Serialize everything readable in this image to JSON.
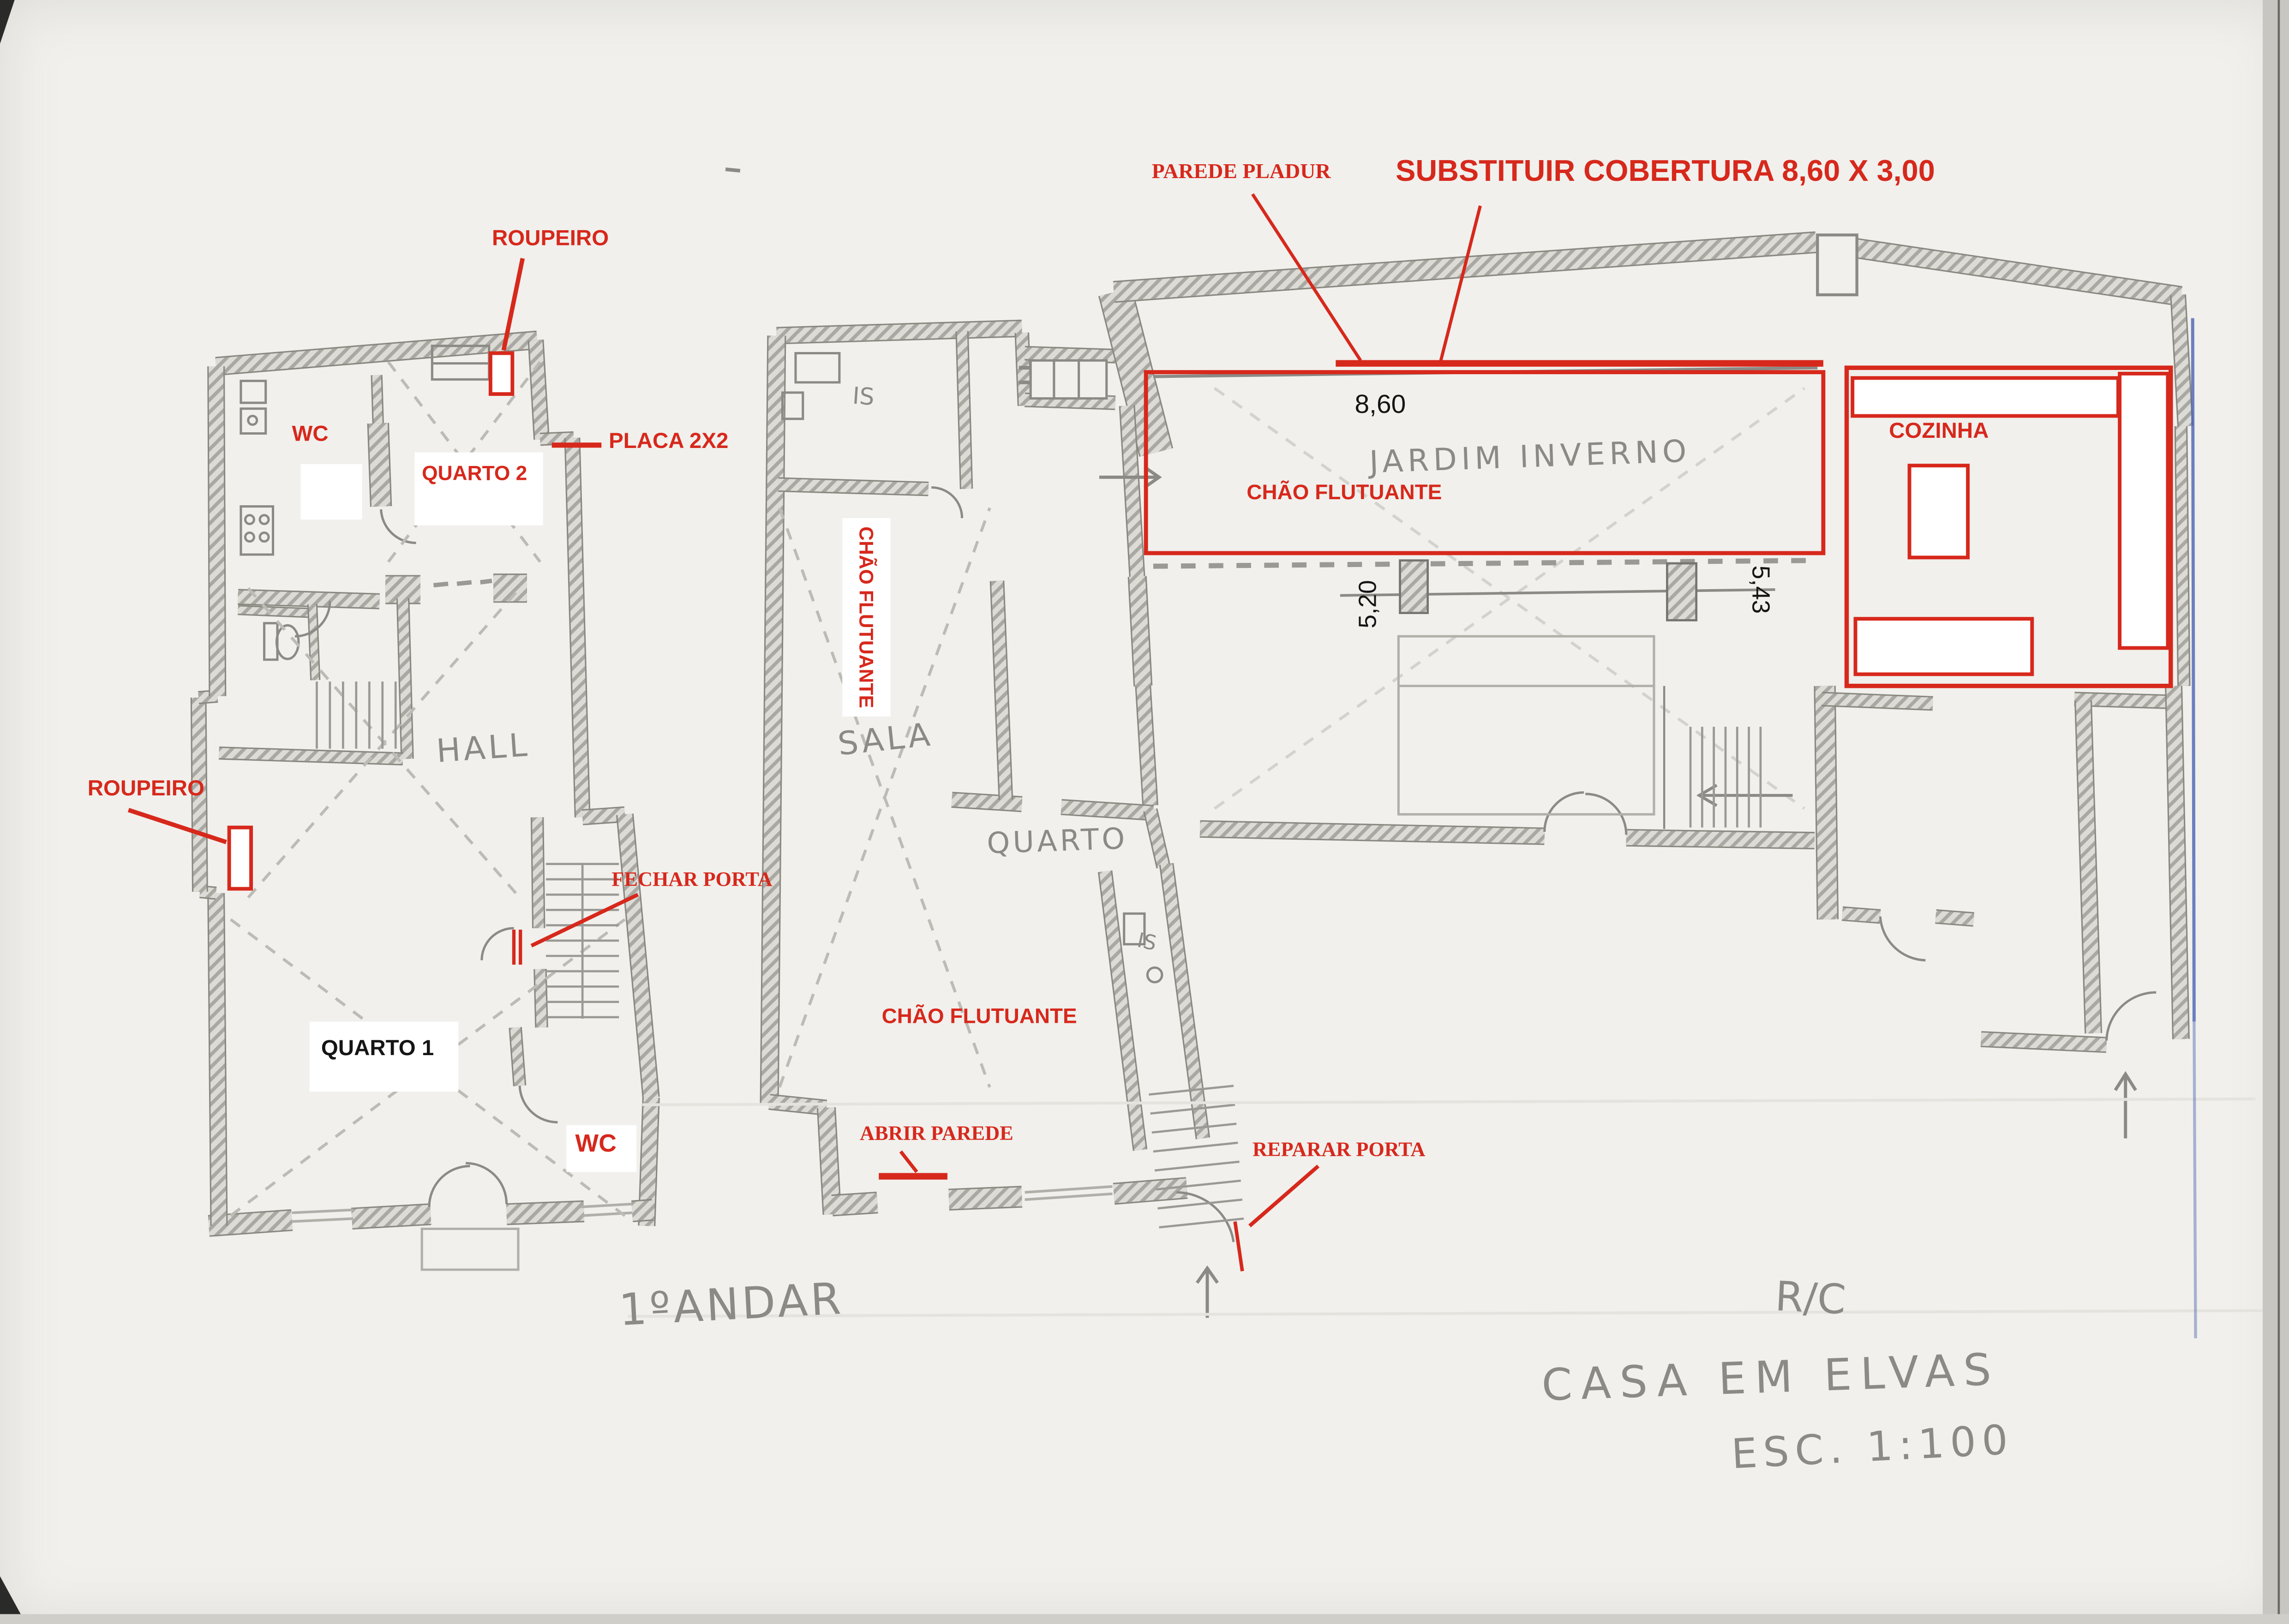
{
  "page": {
    "kind": "scanned hand-drawn architectural floor plan with red renovation notes"
  },
  "colors": {
    "annotation_red": "#d7281c",
    "pencil_gray": "#8b8a85",
    "paper": "#f1f0ec",
    "blue_pen": "#4a63b5",
    "black": "#151515"
  },
  "plans": {
    "left": {
      "name": "1ºANDAR",
      "rooms": {
        "wc_upper": "WC",
        "quarto2": "QUARTO 2",
        "hall": "HALL",
        "quarto1": "QUARTO 1",
        "wc_lower": "WC"
      },
      "red_notes": {
        "roupeiro_top": "ROUPEIRO",
        "roupeiro_left": "ROUPEIRO",
        "placa": "PLACA 2X2",
        "fechar_porta": "FECHAR PORTA"
      }
    },
    "right": {
      "name": "R/C",
      "rooms": {
        "is_top": "IS",
        "sala": "SALA",
        "quarto": "QUARTO",
        "is_mid": "IS",
        "jardim_inverno": "JARDIM INVERNO",
        "cozinha": "COZINHA"
      },
      "red_notes": {
        "parede_pladur": "PAREDE PLADUR",
        "substituir_cobertura": "SUBSTITUIR COBERTURA 8,60 X 3,00",
        "chao_flutuante_upper": "CHÃO FLUTUANTE",
        "chao_flutuante_vertical": "CHÃO FLUTUANTE",
        "chao_flutuante_lower": "CHÃO FLUTUANTE",
        "abrir_parede": "ABRIR PAREDE",
        "reparar_porta": "REPARAR PORTA"
      },
      "dimensions": {
        "jardim_width": "8,60",
        "left_height": "5,20",
        "right_height": "5,43"
      }
    }
  },
  "title_block": {
    "floor": "R/C",
    "project": "CASA EM ELVAS",
    "scale": "ESC. 1:100"
  }
}
